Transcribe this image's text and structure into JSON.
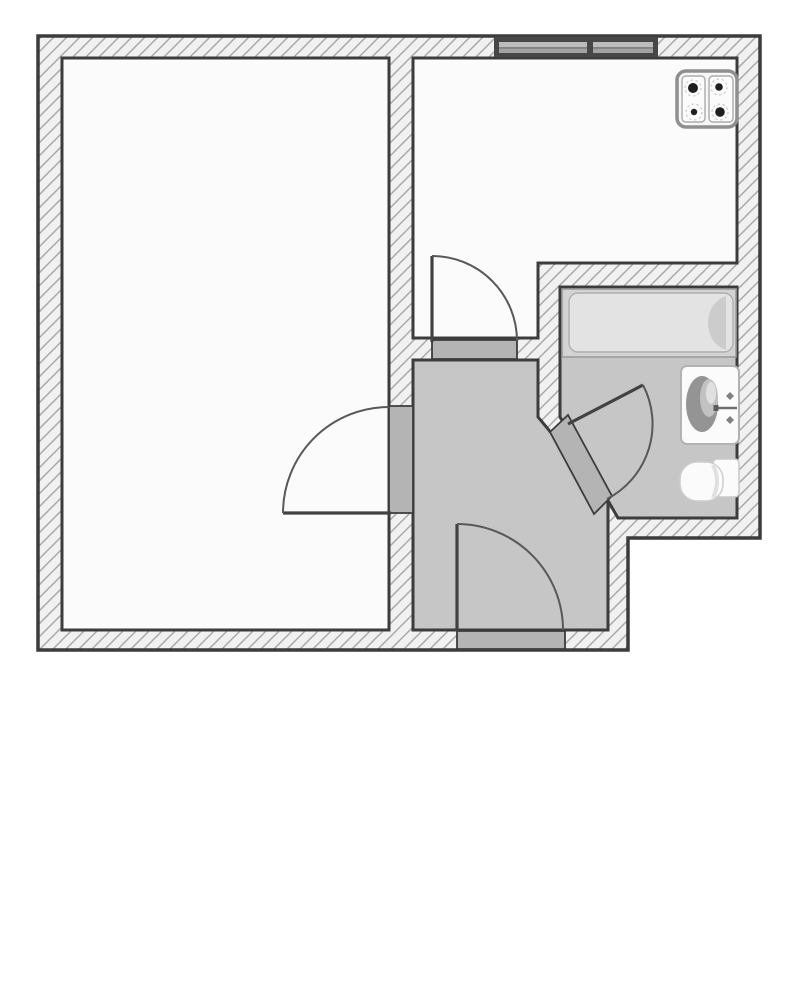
{
  "canvas": {
    "width": 800,
    "height": 1000
  },
  "colors": {
    "background": "#ffffff",
    "wall_fill": "#f1f1f1",
    "wall_hatch_line": "#a9a9a9",
    "wall_outline": "#3c3c3c",
    "room_floor": "#fbfbfb",
    "wet_floor": "#c6c6c6",
    "threshold": "#b4b4b4",
    "door_line": "#424242",
    "door_arc": "#585858",
    "window_frame": "#474747",
    "window_pane_light": "#bcbcbc",
    "window_pane_dark": "#a2a2a2",
    "fixture_stroke": "#9c9c9c",
    "fixture_fill": "#fbfbfb",
    "burner": "#1f1f1f"
  },
  "rooms": [
    {
      "name": "living-room",
      "floor": "room_floor",
      "points": [
        [
          62,
          58
        ],
        [
          389,
          58
        ],
        [
          389,
          630
        ],
        [
          62,
          630
        ]
      ]
    },
    {
      "name": "kitchen",
      "floor": "room_floor",
      "points": [
        [
          413,
          58
        ],
        [
          737,
          58
        ],
        [
          737,
          263
        ],
        [
          538,
          263
        ],
        [
          538,
          338
        ],
        [
          413,
          338
        ]
      ]
    },
    {
      "name": "hallway",
      "floor": "wet_floor",
      "points": [
        [
          413,
          360
        ],
        [
          538,
          360
        ],
        [
          538,
          417
        ],
        [
          608,
          501
        ],
        [
          608,
          630
        ],
        [
          413,
          630
        ]
      ]
    },
    {
      "name": "bathroom",
      "floor": "wet_floor",
      "points": [
        [
          560,
          287
        ],
        [
          737,
          287
        ],
        [
          737,
          518
        ],
        [
          618,
          518
        ],
        [
          560,
          417
        ]
      ]
    }
  ],
  "outer_outline": [
    [
      38,
      36
    ],
    [
      760,
      36
    ],
    [
      760,
      538
    ],
    [
      628,
      538
    ],
    [
      628,
      650
    ],
    [
      38,
      650
    ]
  ],
  "walls": [
    {
      "name": "wall-top",
      "points": [
        [
          38,
          36
        ],
        [
          760,
          36
        ],
        [
          760,
          58
        ],
        [
          38,
          58
        ]
      ]
    },
    {
      "name": "wall-left",
      "points": [
        [
          38,
          36
        ],
        [
          62,
          36
        ],
        [
          62,
          650
        ],
        [
          38,
          650
        ]
      ]
    },
    {
      "name": "wall-right",
      "points": [
        [
          737,
          36
        ],
        [
          760,
          36
        ],
        [
          760,
          538
        ],
        [
          737,
          538
        ]
      ]
    },
    {
      "name": "wall-bottom",
      "points": [
        [
          38,
          630
        ],
        [
          628,
          630
        ],
        [
          628,
          650
        ],
        [
          38,
          650
        ]
      ]
    },
    {
      "name": "wall-bathroom-bottom",
      "points": [
        [
          608,
          518
        ],
        [
          760,
          518
        ],
        [
          760,
          538
        ],
        [
          608,
          538
        ]
      ]
    },
    {
      "name": "wall-hall-right",
      "points": [
        [
          608,
          518
        ],
        [
          628,
          518
        ],
        [
          628,
          650
        ],
        [
          608,
          650
        ]
      ]
    },
    {
      "name": "wall-living-divider-upper",
      "points": [
        [
          389,
          58
        ],
        [
          413,
          58
        ],
        [
          413,
          406
        ],
        [
          389,
          406
        ]
      ]
    },
    {
      "name": "wall-living-divider-lower",
      "points": [
        [
          389,
          513
        ],
        [
          413,
          513
        ],
        [
          413,
          630
        ],
        [
          389,
          630
        ]
      ]
    },
    {
      "name": "wall-kitchen-hall",
      "points": [
        [
          413,
          338
        ],
        [
          538,
          338
        ],
        [
          538,
          360
        ],
        [
          413,
          360
        ]
      ]
    },
    {
      "name": "wall-kitchen-bath",
      "points": [
        [
          538,
          263
        ],
        [
          760,
          263
        ],
        [
          760,
          287
        ],
        [
          538,
          287
        ]
      ]
    },
    {
      "name": "wall-bath-left",
      "points": [
        [
          538,
          263
        ],
        [
          560,
          263
        ],
        [
          560,
          417
        ],
        [
          538,
          417
        ]
      ]
    },
    {
      "name": "wall-bath-diagonal",
      "points": [
        [
          538,
          417
        ],
        [
          560,
          417
        ],
        [
          618,
          518
        ],
        [
          608,
          518
        ],
        [
          608,
          501
        ]
      ]
    }
  ],
  "thresholds": [
    {
      "name": "living-room-door-opening",
      "points": [
        [
          389,
          406
        ],
        [
          413,
          406
        ],
        [
          413,
          513
        ],
        [
          389,
          513
        ]
      ]
    },
    {
      "name": "kitchen-door-threshold",
      "points": [
        [
          432,
          340
        ],
        [
          517,
          340
        ],
        [
          517,
          359
        ],
        [
          432,
          359
        ]
      ]
    },
    {
      "name": "entrance-threshold",
      "points": [
        [
          457,
          631
        ],
        [
          565,
          631
        ],
        [
          565,
          649
        ],
        [
          457,
          649
        ]
      ]
    },
    {
      "name": "bathroom-door-opening",
      "points": [
        [
          550,
          432
        ],
        [
          568,
          415
        ],
        [
          612,
          496
        ],
        [
          594,
          514
        ]
      ]
    }
  ],
  "doors": [
    {
      "name": "living-room-door",
      "leaf": [
        [
          283,
          513
        ],
        [
          391,
          513
        ]
      ],
      "arc": {
        "from": [
          283,
          513
        ],
        "to": [
          389,
          407
        ],
        "r": 106
      }
    },
    {
      "name": "kitchen-door",
      "leaf": [
        [
          432,
          256
        ],
        [
          432,
          342
        ]
      ],
      "arc": {
        "from": [
          432,
          256
        ],
        "to": [
          517,
          341
        ],
        "r": 85
      }
    },
    {
      "name": "entrance-door",
      "leaf": [
        [
          457,
          524
        ],
        [
          457,
          631
        ]
      ],
      "arc": {
        "from": [
          457,
          524
        ],
        "to": [
          563,
          630
        ],
        "r": 106
      }
    },
    {
      "name": "bathroom-door",
      "leaf": [
        [
          568,
          424
        ],
        [
          643,
          385
        ]
      ],
      "arc": {
        "from": [
          643,
          385
        ],
        "to": [
          607,
          499
        ],
        "r": 84.5
      }
    }
  ],
  "window": {
    "name": "kitchen-window",
    "frame": [
      494,
      37,
      658,
      57
    ],
    "panes": [
      [
        499,
        42,
        587,
        53
      ],
      [
        593,
        42,
        653,
        53
      ]
    ],
    "split_y": 47.5
  },
  "fixtures": {
    "stove": {
      "outer": [
        677,
        71,
        737,
        127
      ],
      "panels": [
        [
          682,
          76,
          705,
          122
        ],
        [
          709,
          76,
          733,
          122
        ]
      ],
      "burners": [
        {
          "c": [
            693,
            88
          ],
          "r": 5.0
        },
        {
          "c": [
            694,
            112
          ],
          "r": 3.2
        },
        {
          "c": [
            719,
            87
          ],
          "r": 3.8
        },
        {
          "c": [
            720,
            112
          ],
          "r": 4.8
        }
      ],
      "halo_r": 8
    },
    "bathtub": {
      "outer": [
        562,
        289,
        736,
        357
      ],
      "inner": [
        569,
        293,
        733,
        352
      ],
      "end_cap": {
        "flat_x": 726,
        "top": 296,
        "bottom": 350,
        "bulge_x": 702
      }
    },
    "sink": {
      "body": [
        681,
        366,
        739,
        444
      ],
      "basin": {
        "c": [
          702,
          404
        ],
        "rx": 16,
        "ry": 28
      },
      "basin_hi": {
        "c": [
          709,
          398
        ],
        "rx": 9,
        "ry": 19
      },
      "basin_hi2": {
        "c": [
          711,
          393
        ],
        "rx": 5,
        "ry": 11
      },
      "faucet_line": [
        [
          716,
          408
        ],
        [
          737,
          408
        ]
      ],
      "knobs": [
        [
          730,
          396
        ],
        [
          730,
          420
        ]
      ]
    },
    "toilet": {
      "tank": [
        713,
        459,
        739,
        497
      ],
      "bowl": [
        680,
        462,
        723,
        501
      ]
    }
  }
}
